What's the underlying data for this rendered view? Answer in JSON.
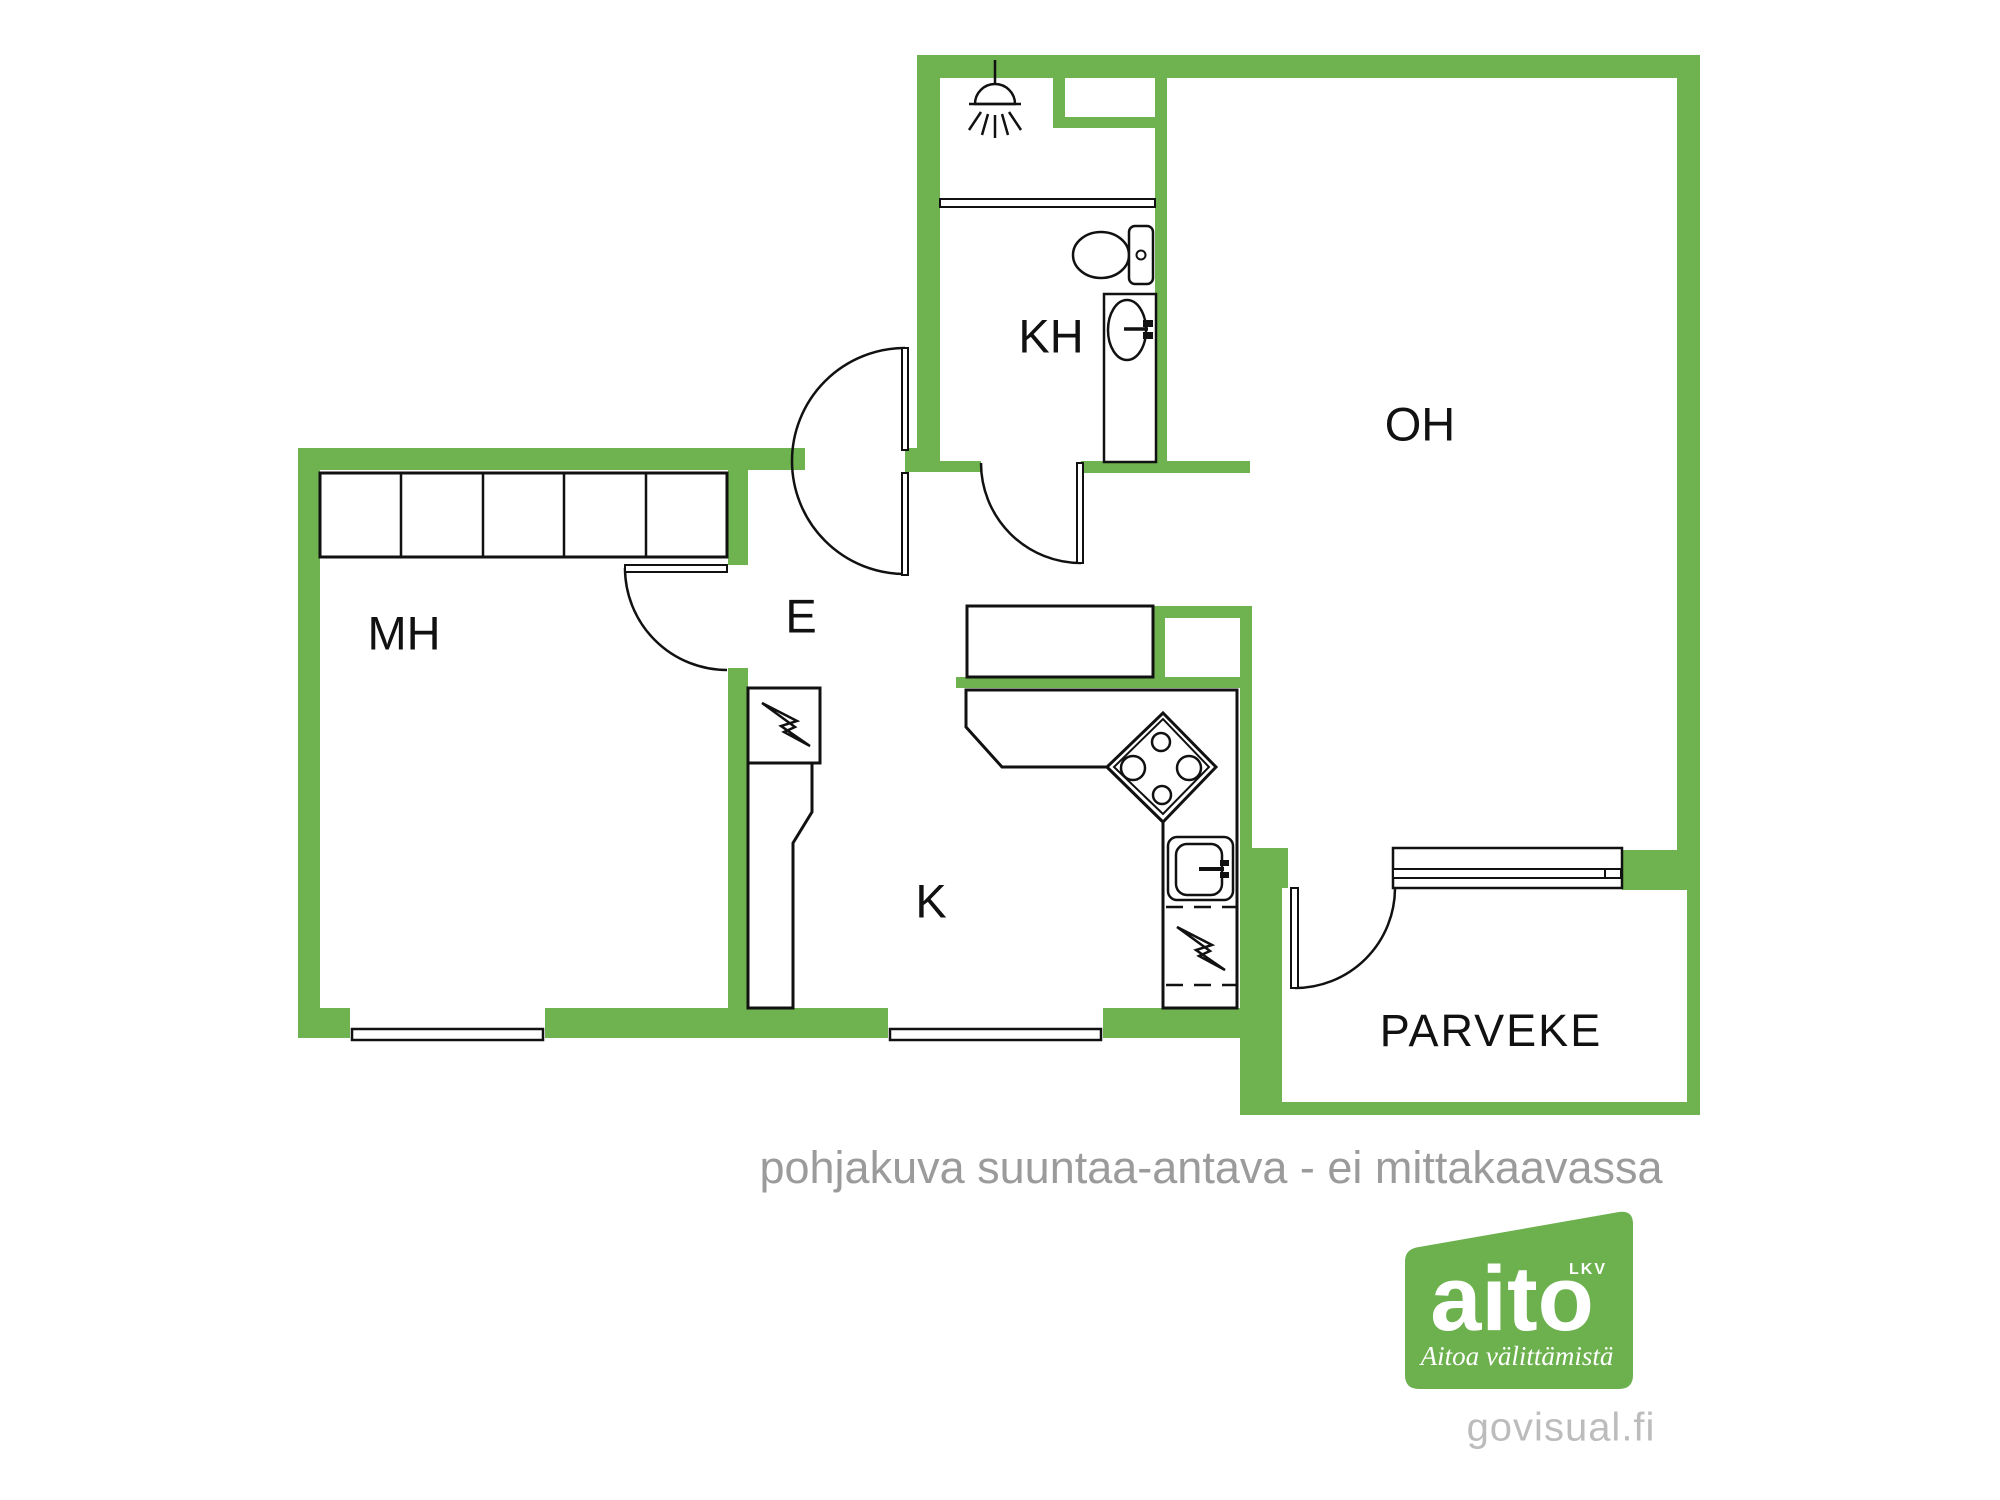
{
  "colors": {
    "wall_green": "#6fb351",
    "caption_gray": "#9b9b9b",
    "watermark_gray": "#bcbcbc",
    "logo_green": "#6cb14e",
    "line_black": "#111111"
  },
  "rooms": {
    "kh": "KH",
    "oh": "OH",
    "e": "E",
    "mh": "MH",
    "k": "K",
    "parveke": "PARVEKE"
  },
  "caption": "pohjakuva suuntaa-antava - ei mittakaavassa",
  "watermark": "govisual.fi",
  "logo": {
    "brand": "aito",
    "suffix": "LKV",
    "tagline": "Aitoa välittämistä"
  },
  "icons": [
    "shower-icon",
    "toilet-icon",
    "washbasin-icon",
    "stove-icon",
    "kitchen-sink-icon",
    "electric-panel-icon",
    "dishwasher-icon"
  ]
}
